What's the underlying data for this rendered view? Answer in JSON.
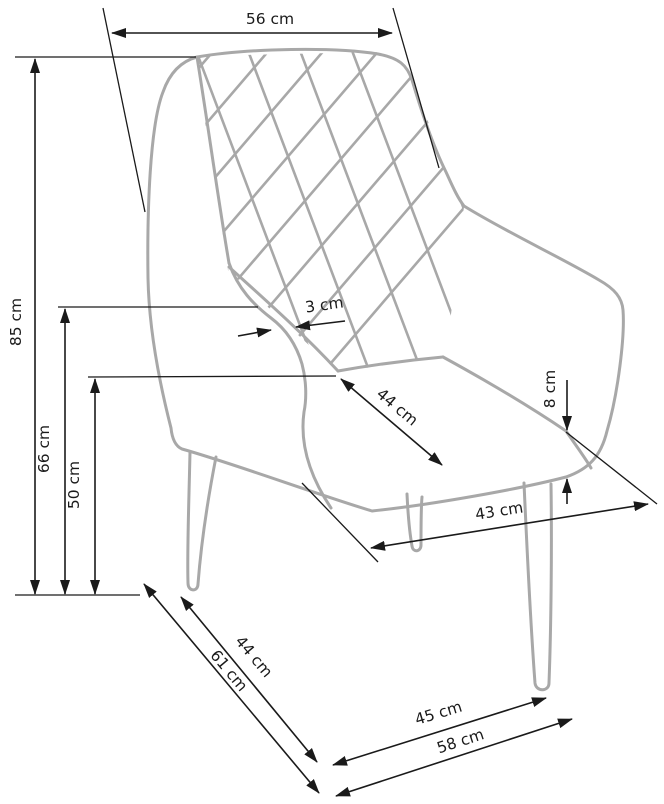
{
  "diagram": {
    "type": "dimension-drawing",
    "subject": "upholstered armchair with quilted backrest, three-quarter view",
    "unit": "cm",
    "colors": {
      "chair_outline": "#a8a8a8",
      "dimension": "#1a1a1a",
      "background": "#ffffff"
    },
    "dimensions": [
      {
        "id": "back-width-top",
        "label": "56 cm",
        "value": 56
      },
      {
        "id": "total-height",
        "label": "85 cm",
        "value": 85
      },
      {
        "id": "armrest-height",
        "label": "66 cm",
        "value": 66
      },
      {
        "id": "seat-height",
        "label": "50 cm",
        "value": 50
      },
      {
        "id": "armrest-thickness",
        "label": "3 cm",
        "value": 3
      },
      {
        "id": "seat-depth",
        "label": "44 cm",
        "value": 44
      },
      {
        "id": "seat-cushion-height",
        "label": "8 cm",
        "value": 8
      },
      {
        "id": "base-depth",
        "label": "43 cm",
        "value": 43
      },
      {
        "id": "side-depth",
        "label": "44 cm",
        "value": 44
      },
      {
        "id": "total-depth",
        "label": "61 cm",
        "value": 61
      },
      {
        "id": "front-leg-spacing",
        "label": "45 cm",
        "value": 45
      },
      {
        "id": "total-width",
        "label": "58 cm",
        "value": 58
      }
    ]
  }
}
